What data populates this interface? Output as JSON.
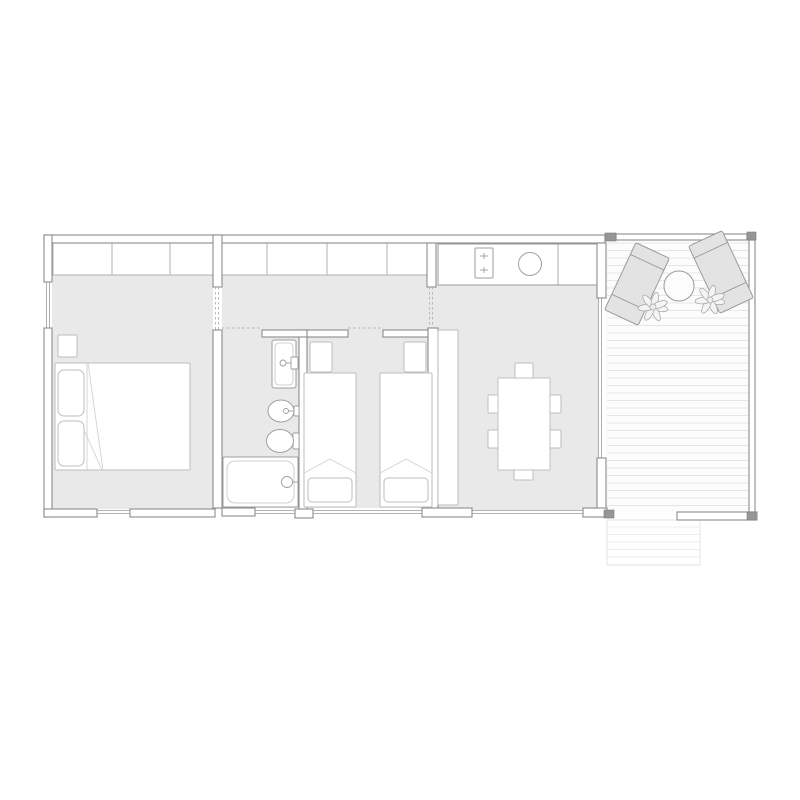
{
  "canvas": {
    "width": 800,
    "height": 800,
    "background": "#ffffff"
  },
  "palette": {
    "floor": "#e9e9e9",
    "wall_fill": "#ffffff",
    "wall_stroke": "#8c8c8c",
    "window_stroke": "#9a9a9a",
    "door_dash": "#b3b3b3",
    "closet_stroke": "#b0b0b0",
    "furniture_stroke": "#bdbdbd",
    "fixture_stroke": "#9e9e9e",
    "counter_stroke": "#9a9a9a",
    "dark_block": "#969696",
    "deck_bg": "#fcfcfc",
    "deck_line": "#e6e6e6",
    "steps_line": "#ececec",
    "steps_edge": "#dcdcdc",
    "lounger_fill": "#e3e3e3",
    "lounger_stroke": "#9a9a9a",
    "plant_fill": "#f4f4f4",
    "plant_stroke": "#ababab",
    "white": "#ffffff"
  },
  "floors": [
    {
      "n": "floor-bedroom1",
      "x": 52,
      "y": 273,
      "w": 161,
      "h": 236
    },
    {
      "n": "floor-hallway",
      "x": 222,
      "y": 275,
      "w": 206,
      "h": 55
    },
    {
      "n": "floor-hall-living-passage",
      "x": 428,
      "y": 287,
      "w": 8,
      "h": 41
    },
    {
      "n": "floor-bathroom",
      "x": 222,
      "y": 330,
      "w": 78,
      "h": 178
    },
    {
      "n": "floor-bedroom2",
      "x": 307,
      "y": 330,
      "w": 121,
      "h": 178
    },
    {
      "n": "floor-living-room",
      "x": 436,
      "y": 285,
      "w": 162,
      "h": 225
    }
  ],
  "deck": {
    "x": 606,
    "y": 236,
    "w": 149,
    "h": 276,
    "plank_gap": 7.5,
    "plank_y1": 243,
    "plank_y2": 508,
    "steps": {
      "x": 607,
      "y": 520,
      "w": 93,
      "h": 45,
      "plank_gap": 7.5
    }
  },
  "walls": [
    {
      "n": "wall-top",
      "x": 44,
      "y": 235,
      "w": 561,
      "h": 8
    },
    {
      "n": "wall-left-upper",
      "x": 44,
      "y": 235,
      "w": 8,
      "h": 47
    },
    {
      "n": "wall-left-lower",
      "x": 44,
      "y": 328,
      "w": 8,
      "h": 189
    },
    {
      "n": "wall-pier-bedroom1-hall",
      "x": 213,
      "y": 235,
      "w": 9,
      "h": 52
    },
    {
      "n": "wall-bedroom1-bathroom",
      "x": 213,
      "y": 330,
      "w": 9,
      "h": 178
    },
    {
      "n": "wall-pier-hall-living",
      "x": 427,
      "y": 243,
      "w": 9,
      "h": 44
    },
    {
      "n": "wall-bedroom2-living",
      "x": 428,
      "y": 328,
      "w": 10,
      "h": 180
    },
    {
      "n": "wall-bathroom-bedroom2",
      "x": 299,
      "y": 330,
      "w": 8,
      "h": 188
    },
    {
      "n": "wall-bathroom-top",
      "x": 262,
      "y": 330,
      "w": 46,
      "h": 7
    },
    {
      "n": "wall-bedroom2-top-left",
      "x": 307,
      "y": 330,
      "w": 41,
      "h": 7
    },
    {
      "n": "wall-bedroom2-top-right",
      "x": 383,
      "y": 330,
      "w": 45,
      "h": 7
    },
    {
      "n": "wall-right-pier-upper",
      "x": 597,
      "y": 243,
      "w": 9,
      "h": 55
    },
    {
      "n": "wall-right-pier-lower",
      "x": 597,
      "y": 458,
      "w": 9,
      "h": 59
    },
    {
      "n": "wall-bottom-1",
      "x": 44,
      "y": 509,
      "w": 53,
      "h": 8
    },
    {
      "n": "wall-bottom-2",
      "x": 130,
      "y": 509,
      "w": 85,
      "h": 8
    },
    {
      "n": "wall-bottom-bathroom",
      "x": 222,
      "y": 508,
      "w": 33,
      "h": 8
    },
    {
      "n": "wall-bottom-3",
      "x": 295,
      "y": 509,
      "w": 18,
      "h": 9
    },
    {
      "n": "wall-bottom-4",
      "x": 422,
      "y": 508,
      "w": 50,
      "h": 9
    },
    {
      "n": "wall-bottom-5",
      "x": 583,
      "y": 508,
      "w": 24,
      "h": 9
    },
    {
      "n": "deck-rail-top",
      "x": 616,
      "y": 234,
      "w": 131,
      "h": 6
    },
    {
      "n": "deck-rail-right",
      "x": 749,
      "y": 240,
      "w": 6,
      "h": 272
    },
    {
      "n": "deck-wall-bottom",
      "x": 677,
      "y": 512,
      "w": 80,
      "h": 8
    }
  ],
  "dark_blocks": [
    {
      "n": "post-deck-top-left",
      "x": 605,
      "y": 233,
      "w": 11,
      "h": 8
    },
    {
      "n": "post-deck-top-right",
      "x": 747,
      "y": 232,
      "w": 9,
      "h": 8
    },
    {
      "n": "post-house-bottom-right",
      "x": 604,
      "y": 510,
      "w": 10,
      "h": 8
    },
    {
      "n": "post-deck-bottom-right",
      "x": 747,
      "y": 512,
      "w": 9,
      "h": 8
    }
  ],
  "windows": [
    {
      "n": "window-left",
      "o": "v",
      "x": 48,
      "a": 282,
      "b": 328
    },
    {
      "n": "window-living-slider",
      "o": "v",
      "x": 600,
      "a": 298,
      "b": 458
    },
    {
      "n": "window-bedroom1",
      "o": "h",
      "y": 512,
      "a": 97,
      "b": 130
    },
    {
      "n": "window-bathroom",
      "o": "h",
      "y": 512,
      "a": 255,
      "b": 295
    },
    {
      "n": "window-bedroom2",
      "o": "h",
      "y": 512,
      "a": 313,
      "b": 422
    },
    {
      "n": "window-living",
      "o": "h",
      "y": 512,
      "a": 472,
      "b": 583
    }
  ],
  "doors": [
    {
      "n": "door-bedroom1",
      "o": "v",
      "x": 217,
      "a": 287,
      "b": 330,
      "dbl": true
    },
    {
      "n": "door-hall-living",
      "o": "v",
      "x": 431,
      "a": 287,
      "b": 328,
      "dbl": true
    },
    {
      "n": "door-bathroom",
      "o": "h",
      "y": 328,
      "a": 222,
      "b": 262,
      "dbl": false
    },
    {
      "n": "door-bedroom2",
      "o": "h",
      "y": 328,
      "a": 348,
      "b": 383,
      "dbl": false
    }
  ],
  "closets": [
    {
      "n": "closet-band-bedroom1",
      "x": 53,
      "y": 243,
      "w": 160,
      "h": 32,
      "dividers": [
        112,
        170
      ]
    },
    {
      "n": "closet-band-hallway",
      "x": 222,
      "y": 243,
      "w": 206,
      "h": 32,
      "dividers": [
        267,
        327,
        387
      ]
    }
  ],
  "kitchen": {
    "counter": {
      "x": 438,
      "y": 244,
      "w": 159,
      "h": 41
    },
    "divider_x": 558,
    "stove": {
      "x": 475,
      "y": 248,
      "w": 18,
      "h": 30
    },
    "burners": [
      [
        484,
        256
      ],
      [
        484,
        270
      ]
    ],
    "sink": {
      "cx": 530,
      "cy": 264,
      "r": 11.5
    }
  },
  "bedroom1": {
    "nightstand": {
      "x": 58,
      "y": 335,
      "w": 19,
      "h": 22
    },
    "bed": {
      "x": 55,
      "y": 363,
      "w": 135,
      "h": 107
    },
    "pillows": [
      {
        "x": 58,
        "y": 370,
        "w": 26,
        "h": 46
      },
      {
        "x": 58,
        "y": 421,
        "w": 26,
        "h": 45
      }
    ],
    "lines": [
      [
        87,
        363,
        87,
        470
      ],
      [
        88,
        363,
        103,
        470
      ],
      [
        84,
        430,
        102,
        470
      ]
    ]
  },
  "bathroom": {
    "sink": {
      "x": 272,
      "y": 340,
      "w": 24,
      "h": 48
    },
    "sink_faucet": {
      "box": [
        291,
        357,
        7,
        12
      ],
      "knob": [
        283,
        363,
        3
      ]
    },
    "bidet": {
      "cx": 281,
      "cy": 411,
      "rx": 13,
      "ry": 11
    },
    "bidet_faucet": {
      "box": [
        294,
        406,
        5,
        10
      ],
      "knob": [
        286,
        411,
        2.5
      ]
    },
    "toilet": {
      "cx": 280,
      "cy": 441,
      "rx": 13.5,
      "ry": 11.5
    },
    "toilet_tank": [
      293,
      433,
      6,
      16
    ],
    "tub": {
      "x": 223,
      "y": 457,
      "w": 75,
      "h": 50
    },
    "tub_drain": [
      287,
      482,
      5.5
    ]
  },
  "bedroom2": {
    "beds": [
      {
        "bed": {
          "x": 304,
          "y": 373,
          "w": 52,
          "h": 134
        },
        "pillow": {
          "x": 310,
          "y": 342,
          "w": 22,
          "h": 30
        },
        "blanket": {
          "x": 308,
          "y": 478,
          "w": 44,
          "h": 24
        },
        "fold": [
          [
            304,
            473
          ],
          [
            330,
            459
          ],
          [
            356,
            473
          ]
        ]
      },
      {
        "bed": {
          "x": 380,
          "y": 373,
          "w": 52,
          "h": 134
        },
        "pillow": {
          "x": 404,
          "y": 342,
          "w": 22,
          "h": 30
        },
        "blanket": {
          "x": 384,
          "y": 478,
          "w": 44,
          "h": 24
        },
        "fold": [
          [
            380,
            473
          ],
          [
            406,
            459
          ],
          [
            432,
            473
          ]
        ]
      }
    ]
  },
  "living": {
    "sideboard": {
      "x": 438,
      "y": 330,
      "w": 20,
      "h": 175
    },
    "table": {
      "x": 498,
      "y": 378,
      "w": 52,
      "h": 92
    },
    "chairs": [
      {
        "x": 515,
        "y": 363,
        "w": 18,
        "h": 15
      },
      {
        "x": 514,
        "y": 470,
        "w": 19,
        "h": 10
      },
      {
        "x": 488,
        "y": 395,
        "w": 11,
        "h": 18
      },
      {
        "x": 488,
        "y": 430,
        "w": 11,
        "h": 18
      },
      {
        "x": 550,
        "y": 395,
        "w": 11,
        "h": 18
      },
      {
        "x": 550,
        "y": 430,
        "w": 11,
        "h": 18
      }
    ]
  },
  "deck_furniture": {
    "loungers": [
      {
        "cx": 637,
        "cy": 284,
        "w": 37,
        "h": 74,
        "angle": 25
      },
      {
        "cx": 721,
        "cy": 272,
        "w": 37,
        "h": 74,
        "angle": -25
      }
    ],
    "table": {
      "cx": 679,
      "cy": 286,
      "r": 15
    },
    "plants": [
      {
        "cx": 653,
        "cy": 307
      },
      {
        "cx": 710,
        "cy": 300
      }
    ]
  }
}
